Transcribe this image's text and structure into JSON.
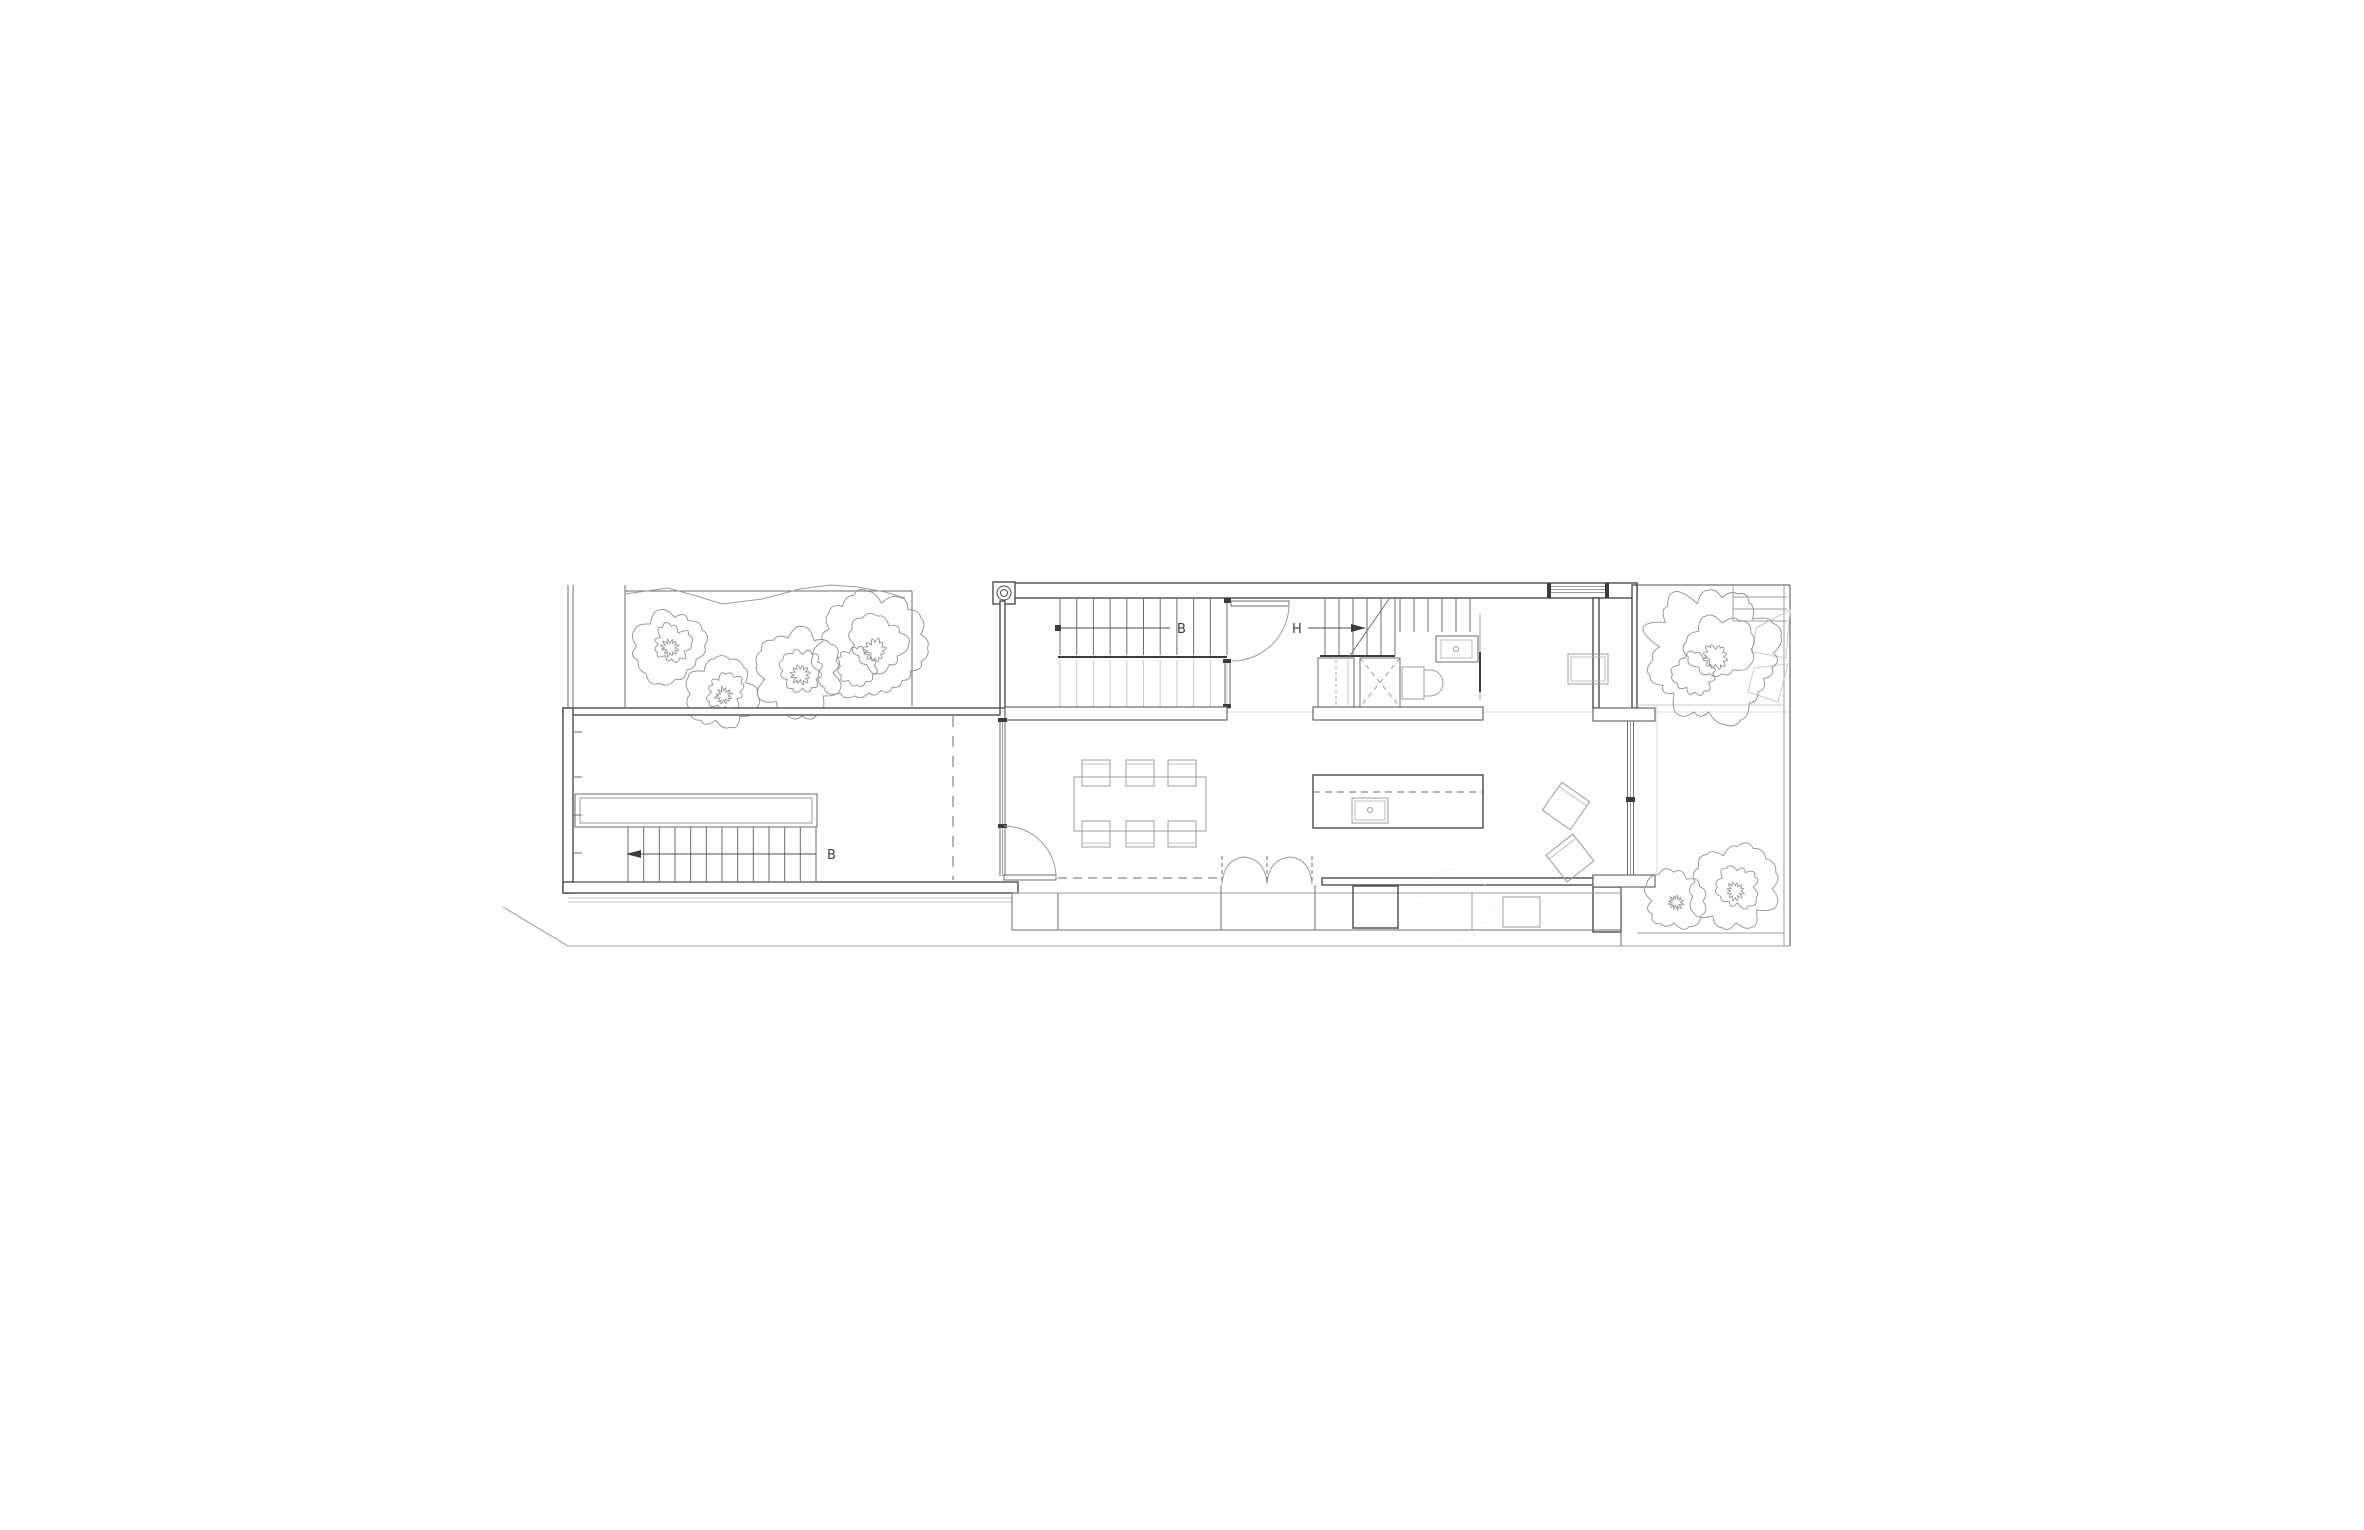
{
  "drawing": {
    "kind": "architectural-floor-plan",
    "labels": {
      "stair_b_lower": "B",
      "stair_b_upper": "B",
      "stair_h": "H"
    },
    "colors": {
      "background": "#ffffff",
      "ink": "#4c4c4c",
      "heavy_line": "#3c3c3c",
      "light_line": "#9c9c9c",
      "faint_line": "#c9c9c9",
      "label_text": "#3d3d3d"
    }
  }
}
